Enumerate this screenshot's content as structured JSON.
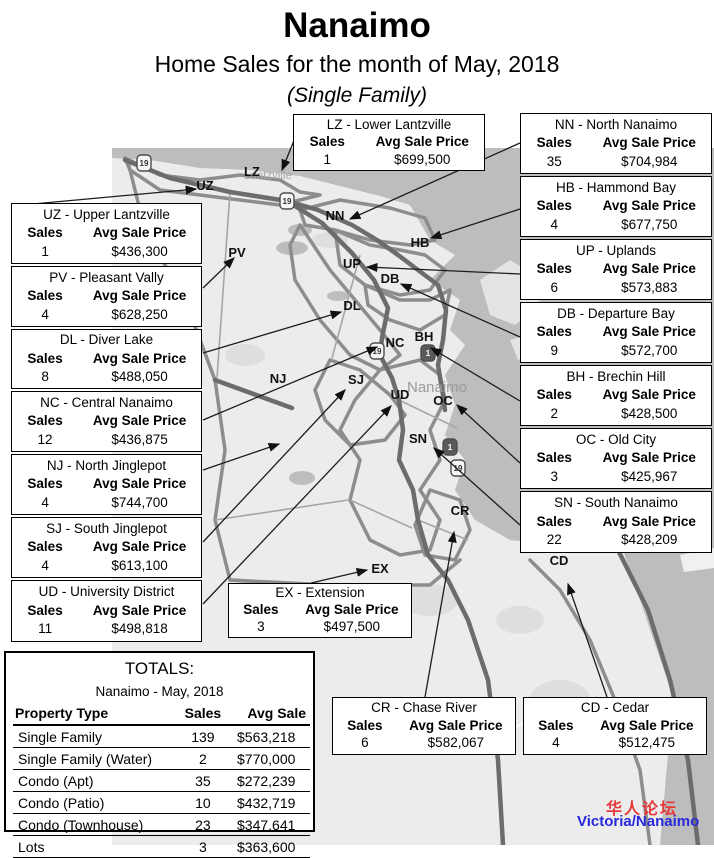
{
  "header": {
    "title": "Nanaimo",
    "subtitle": "Home Sales for the month of May, 2018",
    "subtitle2": "(Single Family)"
  },
  "labels": {
    "sales": "Sales",
    "avg_price": "Avg Sale Price"
  },
  "callouts": [
    {
      "id": "UZ",
      "title": "UZ - Upper Lantzville",
      "sales": "1",
      "price": "$436,300"
    },
    {
      "id": "PV",
      "title": "PV - Pleasant Vally",
      "sales": "4",
      "price": "$628,250"
    },
    {
      "id": "DL",
      "title": "DL - Diver Lake",
      "sales": "8",
      "price": "$488,050"
    },
    {
      "id": "NC",
      "title": "NC - Central Nanaimo",
      "sales": "12",
      "price": "$436,875"
    },
    {
      "id": "NJ",
      "title": "NJ - North Jinglepot",
      "sales": "4",
      "price": "$744,700"
    },
    {
      "id": "SJ",
      "title": "SJ - South Jinglepot",
      "sales": "4",
      "price": "$613,100"
    },
    {
      "id": "UD",
      "title": "UD - University District",
      "sales": "11",
      "price": "$498,818"
    },
    {
      "id": "LZ",
      "title": "LZ - Lower Lantzville",
      "sales": "1",
      "price": "$699,500"
    },
    {
      "id": "NN",
      "title": "NN - North Nanaimo",
      "sales": "35",
      "price": "$704,984"
    },
    {
      "id": "HB",
      "title": "HB - Hammond Bay",
      "sales": "4",
      "price": "$677,750"
    },
    {
      "id": "UP",
      "title": "UP - Uplands",
      "sales": "6",
      "price": "$573,883"
    },
    {
      "id": "DB",
      "title": "DB - Departure Bay",
      "sales": "9",
      "price": "$572,700"
    },
    {
      "id": "BH",
      "title": "BH - Brechin Hill",
      "sales": "2",
      "price": "$428,500"
    },
    {
      "id": "OC",
      "title": "OC - Old City",
      "sales": "3",
      "price": "$425,967"
    },
    {
      "id": "SN",
      "title": "SN - South Nanaimo",
      "sales": "22",
      "price": "$428,209"
    },
    {
      "id": "EX",
      "title": "EX - Extension",
      "sales": "3",
      "price": "$497,500"
    },
    {
      "id": "CR",
      "title": "CR - Chase River",
      "sales": "6",
      "price": "$582,067"
    },
    {
      "id": "CD",
      "title": "CD - Cedar",
      "sales": "4",
      "price": "$512,475"
    }
  ],
  "map": {
    "region_labels": [
      "UZ",
      "LZ",
      "NN",
      "PV",
      "HB",
      "UP",
      "DB",
      "DL",
      "NC",
      "BH",
      "NJ",
      "SJ",
      "UD",
      "OC",
      "SN",
      "CR",
      "EX",
      "CD"
    ],
    "city_labels": [
      "Lantzville",
      "Nanaimo"
    ],
    "highway_shields": [
      "19",
      "19",
      "19",
      "1",
      "1",
      "19"
    ]
  },
  "totals": {
    "title": "TOTALS:",
    "subtitle": "Nanaimo - May, 2018",
    "columns": [
      "Property Type",
      "Sales",
      "Avg Sale"
    ],
    "rows": [
      {
        "type": "Single Family",
        "sales": "139",
        "avg": "$563,218"
      },
      {
        "type": "Single Family (Water)",
        "sales": "2",
        "avg": "$770,000"
      },
      {
        "type": "Condo (Apt)",
        "sales": "35",
        "avg": "$272,239"
      },
      {
        "type": "Condo (Patio)",
        "sales": "10",
        "avg": "$432,719"
      },
      {
        "type": "Condo (Townhouse)",
        "sales": "23",
        "avg": "$347,641"
      },
      {
        "type": "Lots",
        "sales": "3",
        "avg": "$363,600"
      }
    ]
  },
  "watermark": {
    "line1": "华人论坛",
    "line2": "Victoria/Nanaimo",
    "color1": "#e63939",
    "color2": "#2929dd"
  },
  "colors": {
    "water": "#bdbdbd",
    "land": "#ececec",
    "road": "#6c6c6c",
    "boundary": "#8d8d8d"
  }
}
